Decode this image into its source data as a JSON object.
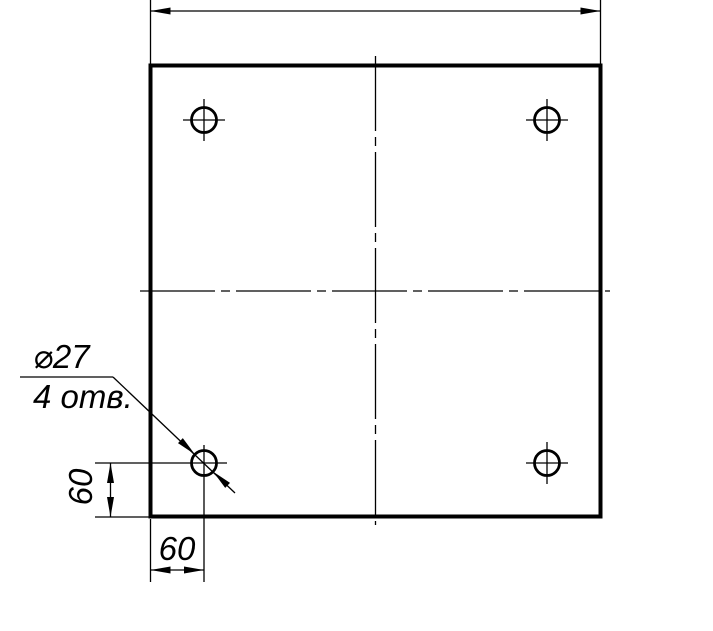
{
  "drawing": {
    "callout": {
      "diameter_label": "⌀27",
      "count_label": "4 отв."
    },
    "dimensions": {
      "left_vertical_label": "60",
      "bottom_horizontal_label": "60"
    },
    "holes": {
      "count": 4,
      "radius_px": 12.5,
      "centers_px": [
        [
          204,
          120
        ],
        [
          547,
          120
        ],
        [
          204,
          463
        ],
        [
          547,
          463
        ]
      ]
    },
    "plate": {
      "left_px": 150,
      "top_px": 65,
      "right_px": 601,
      "bottom_px": 517
    },
    "colors": {
      "line": "#000000",
      "background": "#ffffff"
    }
  }
}
